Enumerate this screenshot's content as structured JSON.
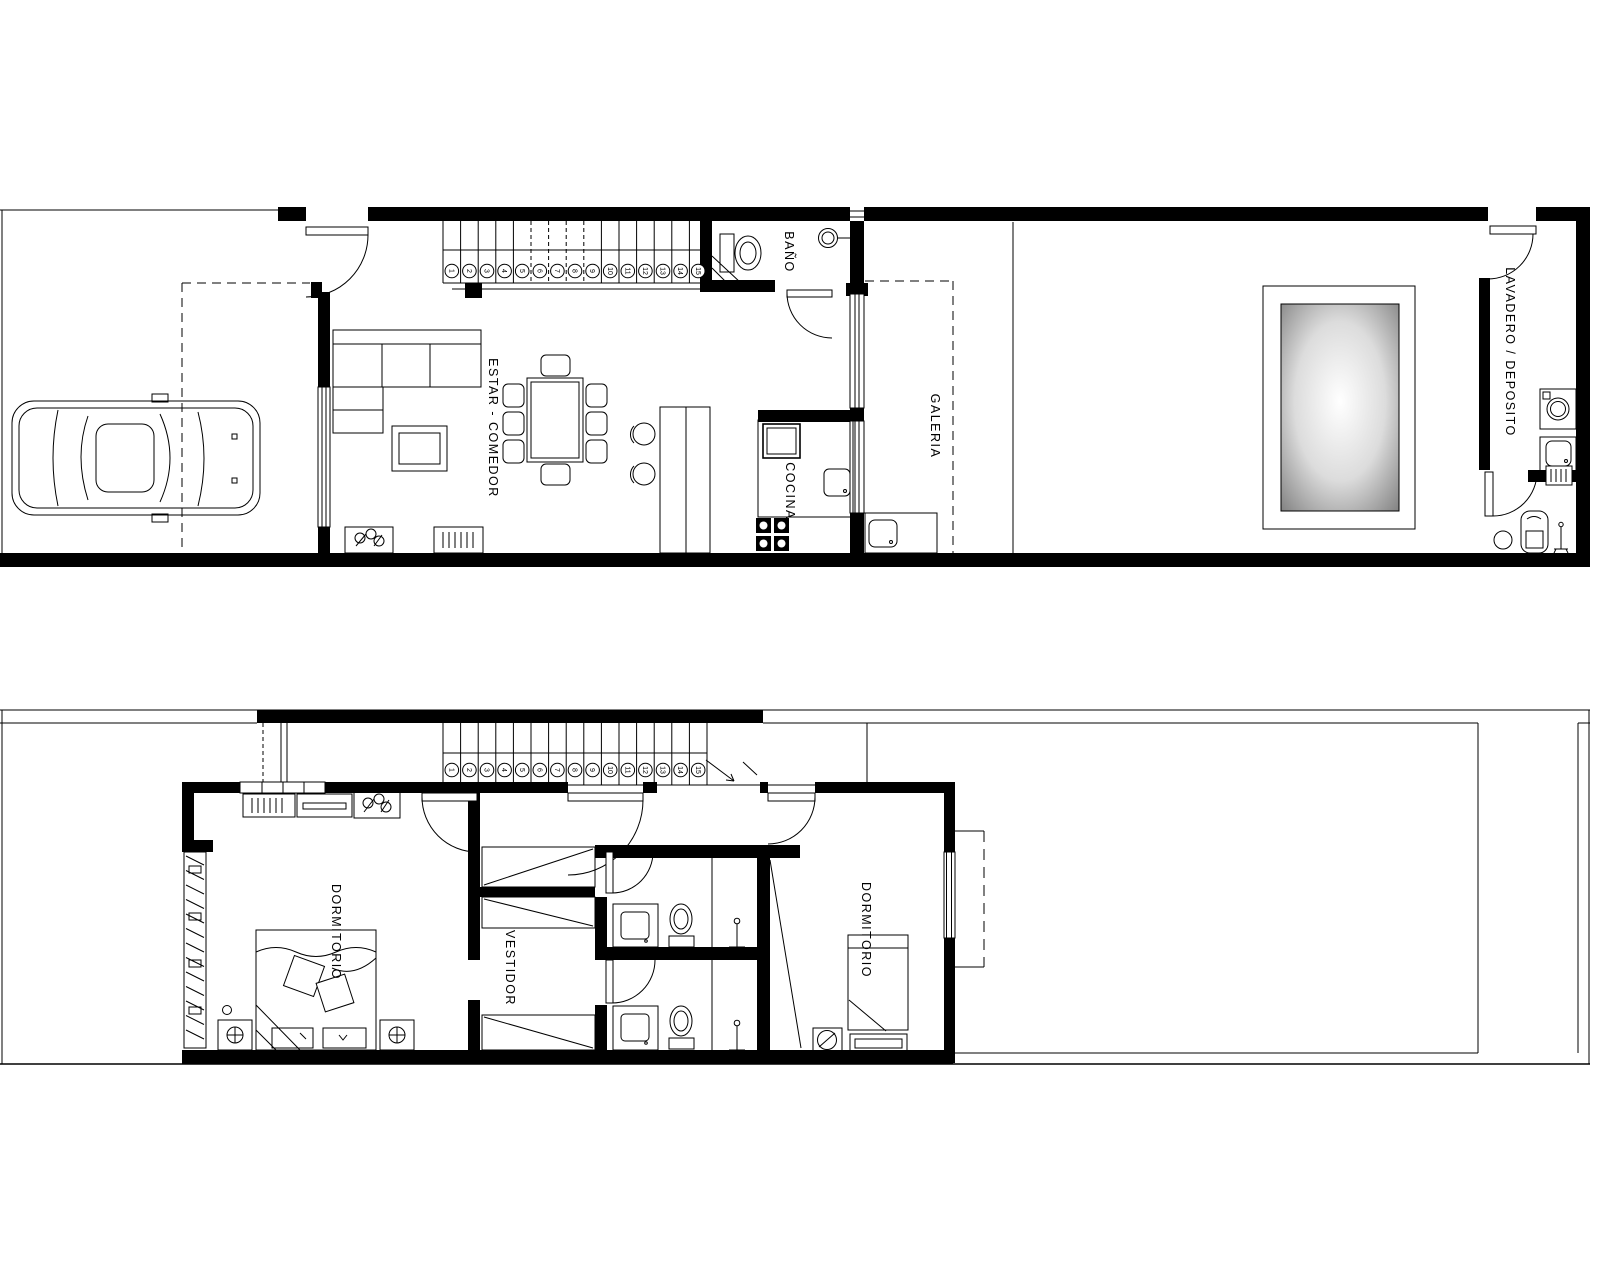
{
  "plans": {
    "ground_floor": {
      "room_labels": {
        "bano": "BAÑO",
        "estar_comedor": "ESTAR - COMEDOR",
        "cocina": "COCINA",
        "galeria": "GALERIA",
        "lavadero_deposito": "LAVADERO / DEPOSITO"
      },
      "stair_numbers": [
        "1",
        "2",
        "3",
        "4",
        "5",
        "6",
        "7",
        "8",
        "9",
        "10",
        "11",
        "12",
        "13",
        "14",
        "15"
      ]
    },
    "upper_floor": {
      "room_labels": {
        "dormitorio_principal": "DORMITORIO",
        "vestidor": "VESTIDOR",
        "dormitorio_secundario": "DORMITORIO"
      },
      "stair_numbers": [
        "1",
        "2",
        "3",
        "4",
        "5",
        "6",
        "7",
        "8",
        "9",
        "10",
        "11",
        "12",
        "13",
        "14",
        "15"
      ]
    }
  },
  "colors": {
    "line": "#000000",
    "background": "#ffffff",
    "pool_center": "#ffffff",
    "pool_mid": "#dcdcdc",
    "pool_edge": "#7e7e7e"
  }
}
